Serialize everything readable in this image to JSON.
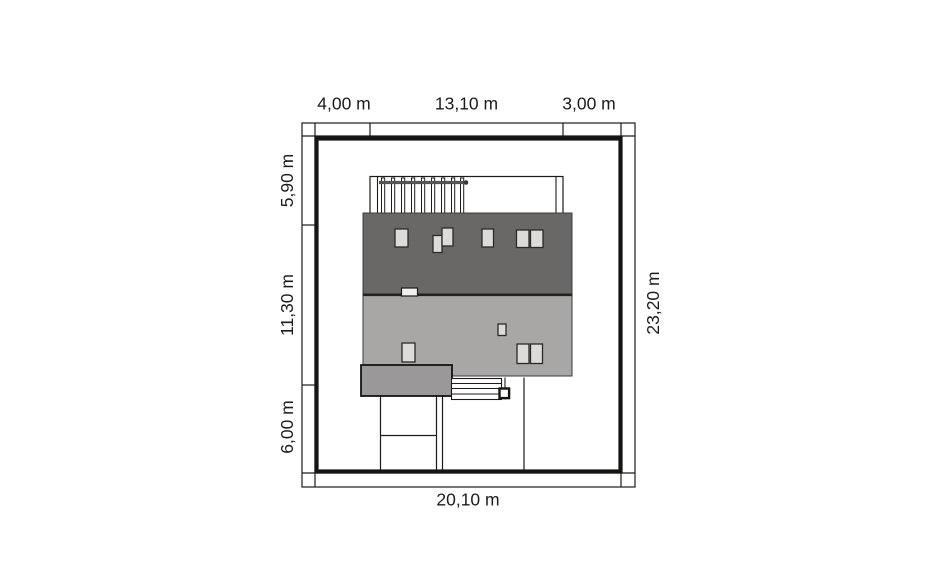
{
  "plan": {
    "dimensions": {
      "top_left": "4,00 m",
      "top_middle": "13,10 m",
      "top_right": "3,00 m",
      "left_top": "5,90 m",
      "left_middle": "11,30 m",
      "left_bottom": "6,00 m",
      "right_side": "23,20 m",
      "bottom": "20,10 m"
    },
    "colors": {
      "upper_roof": "#6a6767",
      "lower_roof": "#a9a7a6",
      "garage_roof": "#9a9898",
      "skylight": "#dddbda",
      "terrace": "#ffffff",
      "line": "#1c1b1a",
      "plot_border": "#161514",
      "background": "#ffffff"
    }
  }
}
